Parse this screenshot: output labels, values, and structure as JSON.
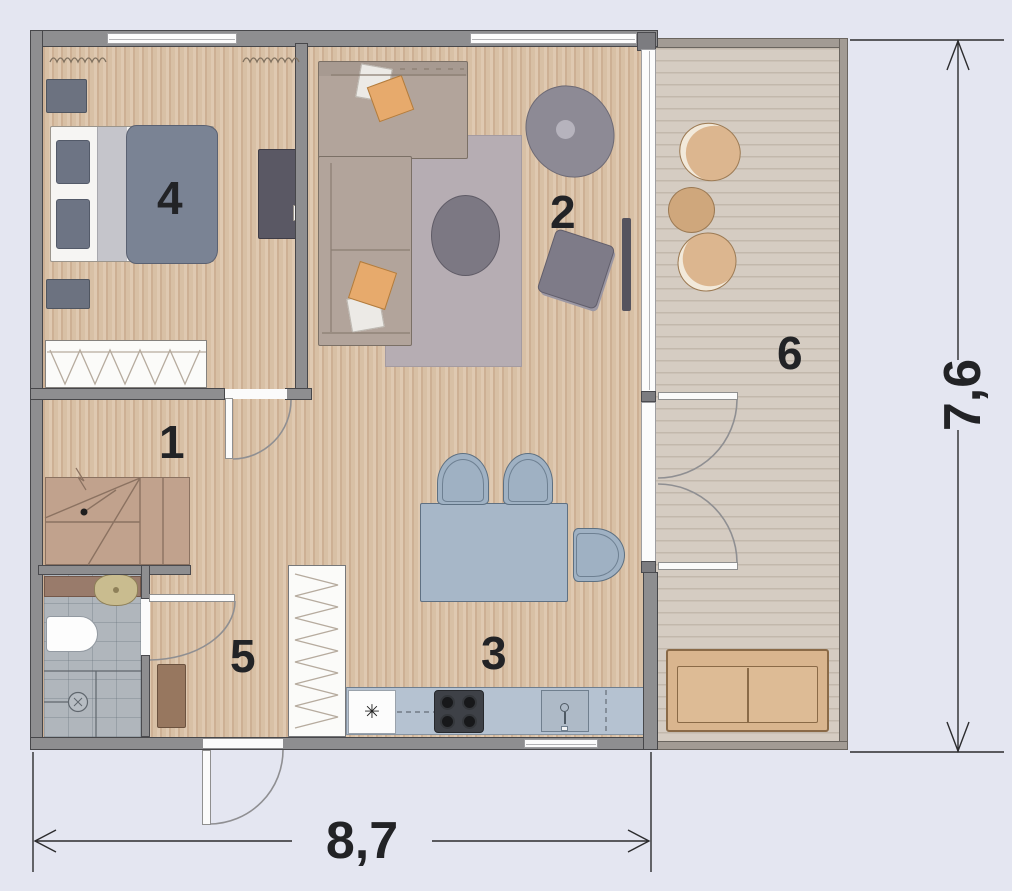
{
  "floor_plan": {
    "room_labels": [
      {
        "label": "1"
      },
      {
        "label": "2"
      },
      {
        "label": "3"
      },
      {
        "label": "4"
      },
      {
        "label": "5"
      },
      {
        "label": "6"
      }
    ],
    "dimensions": {
      "width": "8,7",
      "height": "7,6"
    },
    "symbols": {
      "freezer": "✳"
    },
    "colors": {
      "background": "#e4e6f1",
      "wall": "#8e8e90",
      "wood_floor": "#d8c0a5",
      "terrace_floor": "#d5ccc2",
      "bathroom_floor": "#b0b6bc",
      "textile_slate": "#7a8394",
      "kitchen_blue": "#a7b7c8",
      "outdoor_tan": "#dcb68f",
      "label_text": "#222326"
    }
  }
}
